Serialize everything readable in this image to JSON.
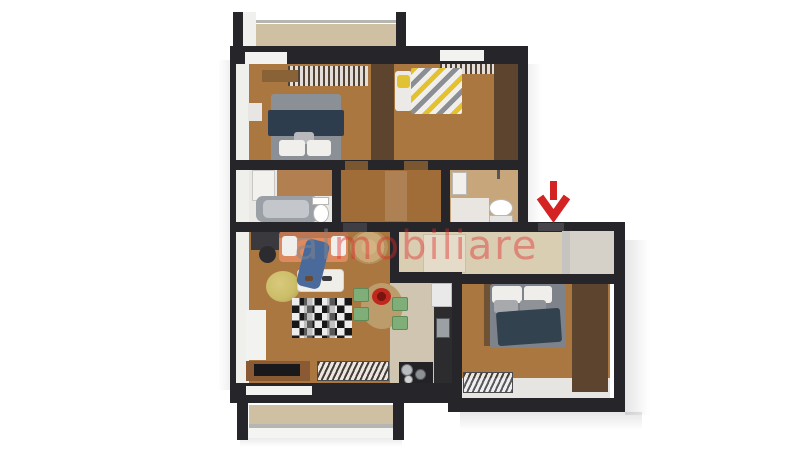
{
  "watermark": {
    "part1": "ai",
    "part2": "mobiliare"
  },
  "entrance_marker": {
    "shape": "down-arrow",
    "meaning": "entrance-pointer",
    "color": "#d32323"
  },
  "palette": {
    "wall": "#26262a",
    "wood": "#a9773f",
    "wood_hall": "#a06d39",
    "decking": "#cfc0a4",
    "tile_beige": "#d9cdb2",
    "tile_kitchen": "#cfc5b0",
    "tile_tan": "#c8a67c",
    "floor_white": "#eae8e4",
    "inner_white": "#efefec",
    "wardrobe_wood": "#5c442e",
    "bed_gray": "#8b8f96",
    "bed_gray_dark": "#7e838b",
    "blanket_navy": "#2e3d4d",
    "blanket_navy2": "#33424f",
    "pillow_white": "#f0efec",
    "pillow_gray": "#a8aaae",
    "sofa_orange": "#dd8a60",
    "throw_blue": "#4a6a9c",
    "jute_rug": "#c9a977",
    "pouf_yellow": "#ccbd69",
    "coffee_table": "#efeee9",
    "dining_wood": "#bd9c6c",
    "chair_green": "#7fae79",
    "bowl_red": "#c0281e",
    "console_wood": "#8a5a34",
    "tv_black": "#19191c",
    "counter_dark": "#2c2c2f",
    "fridge_white": "#e9e9ea",
    "steel": "#9ba0a4",
    "fixture_white": "#f6f5f3",
    "door_wood": "#7a5731",
    "door_dark": "#3e3e44",
    "railing": "#b5b5b2",
    "window_white": "#f2f2f0",
    "arrow_red": "#d32323",
    "watermark_gray": "rgba(134,134,134,0.50)",
    "watermark_red": "rgba(223,38,38,0.42)"
  },
  "floorplan": {
    "rooms": [
      {
        "name": "balcony-top",
        "floor": "wood-decking",
        "features": [
          "railing",
          "posts"
        ]
      },
      {
        "name": "bedroom-1",
        "floor": "hardwood",
        "furniture": [
          "double-bed-gray",
          "navy-blanket",
          "pillows",
          "window-drapes",
          "nightstand",
          "corner-shelf"
        ]
      },
      {
        "name": "bedroom-2",
        "floor": "hardwood",
        "furniture": [
          "double-bed-yellow-gray-chevron",
          "window-drapes",
          "wardrobe"
        ]
      },
      {
        "name": "bathroom-1",
        "floor": "white-tile",
        "furniture": [
          "tall-cabinet",
          "bathtub",
          "toilet"
        ]
      },
      {
        "name": "hallway",
        "floor": "hardwood",
        "furniture": [
          "door-leaf"
        ]
      },
      {
        "name": "bathroom-2",
        "floor": "tan-tile",
        "furniture": [
          "sink",
          "shower-fixture",
          "toilet"
        ]
      },
      {
        "name": "entry-corridor",
        "floor": "beige-tile",
        "furniture": [
          "closet"
        ]
      },
      {
        "name": "vestibule",
        "floor": "gray-tile",
        "furniture": []
      },
      {
        "name": "living-room",
        "floor": "hardwood",
        "furniture": [
          "desk",
          "desk-chair",
          "orange-sofa",
          "blue-throw",
          "round-jute-rug",
          "yellow-pouf",
          "coffee-table",
          "checkered-rug",
          "dining-table",
          "four-green-chairs",
          "red-bowl",
          "slatted-shelf",
          "tv-console",
          "radiator"
        ]
      },
      {
        "name": "kitchen",
        "floor": "beige-tile",
        "furniture": [
          "fridge",
          "counter",
          "sink",
          "stove-with-pots"
        ]
      },
      {
        "name": "bedroom-3",
        "floor": "hardwood",
        "furniture": [
          "double-bed-gray-navy",
          "pillows",
          "wardrobe",
          "radiator"
        ]
      },
      {
        "name": "balcony-bottom",
        "floor": "wood-decking",
        "features": [
          "railing",
          "posts"
        ]
      }
    ]
  }
}
